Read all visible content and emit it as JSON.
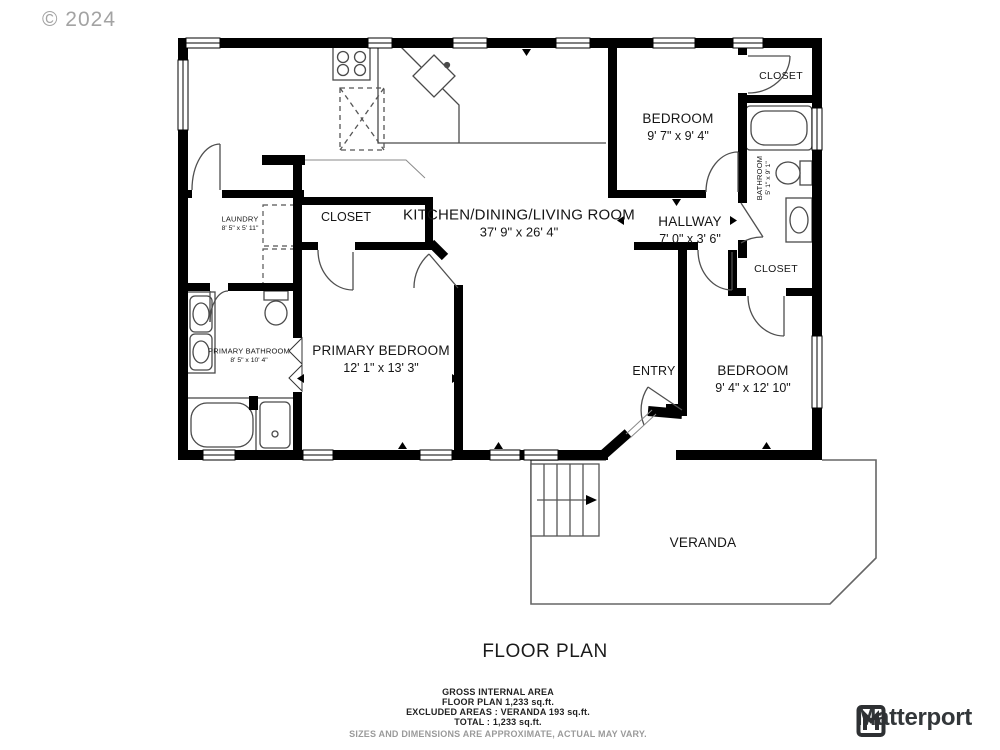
{
  "watermark": "© 2024",
  "title": "FLOOR PLAN",
  "rooms": {
    "kitchen_living": {
      "name": "KITCHEN/DINING/LIVING ROOM",
      "dims": "37' 9\" x 26' 4\""
    },
    "bedroom1": {
      "name": "BEDROOM",
      "dims": "9' 7\" x 9' 4\""
    },
    "closet_top_right": {
      "name": "CLOSET"
    },
    "bathroom": {
      "name": "BATHROOM",
      "dims": "5' 1\" x 9' 1\""
    },
    "hallway": {
      "name": "HALLWAY",
      "dims": "7' 0\" x 3' 6\""
    },
    "closet_right_mid": {
      "name": "CLOSET"
    },
    "bedroom2": {
      "name": "BEDROOM",
      "dims": "9' 4\" x 12' 10\""
    },
    "entry": {
      "name": "ENTRY"
    },
    "veranda": {
      "name": "VERANDA"
    },
    "primary_bedroom": {
      "name": "PRIMARY BEDROOM",
      "dims": "12' 1\" x 13' 3\""
    },
    "primary_bathroom": {
      "name": "PRIMARY BATHROOM",
      "dims": "8' 5\" x 10' 4\""
    },
    "laundry": {
      "name": "LAUNDRY",
      "dims": "8' 5\" x 5' 11\""
    },
    "closet_mid_left": {
      "name": "CLOSET"
    }
  },
  "footer": {
    "line1": "GROSS INTERNAL AREA",
    "line2": "FLOOR PLAN 1,233 sq.ft.",
    "line3": "EXCLUDED AREAS :  VERANDA 193 sq.ft.",
    "line4": "TOTAL :  1,233 sq.ft.",
    "disclaimer": "SIZES AND DIMENSIONS ARE APPROXIMATE, ACTUAL MAY VARY."
  },
  "logo": {
    "text": "Matterport"
  },
  "colors": {
    "wall": "#000000",
    "fixture": "#4a4a4a",
    "label": "#151515",
    "muted": "#9a9a9a"
  }
}
